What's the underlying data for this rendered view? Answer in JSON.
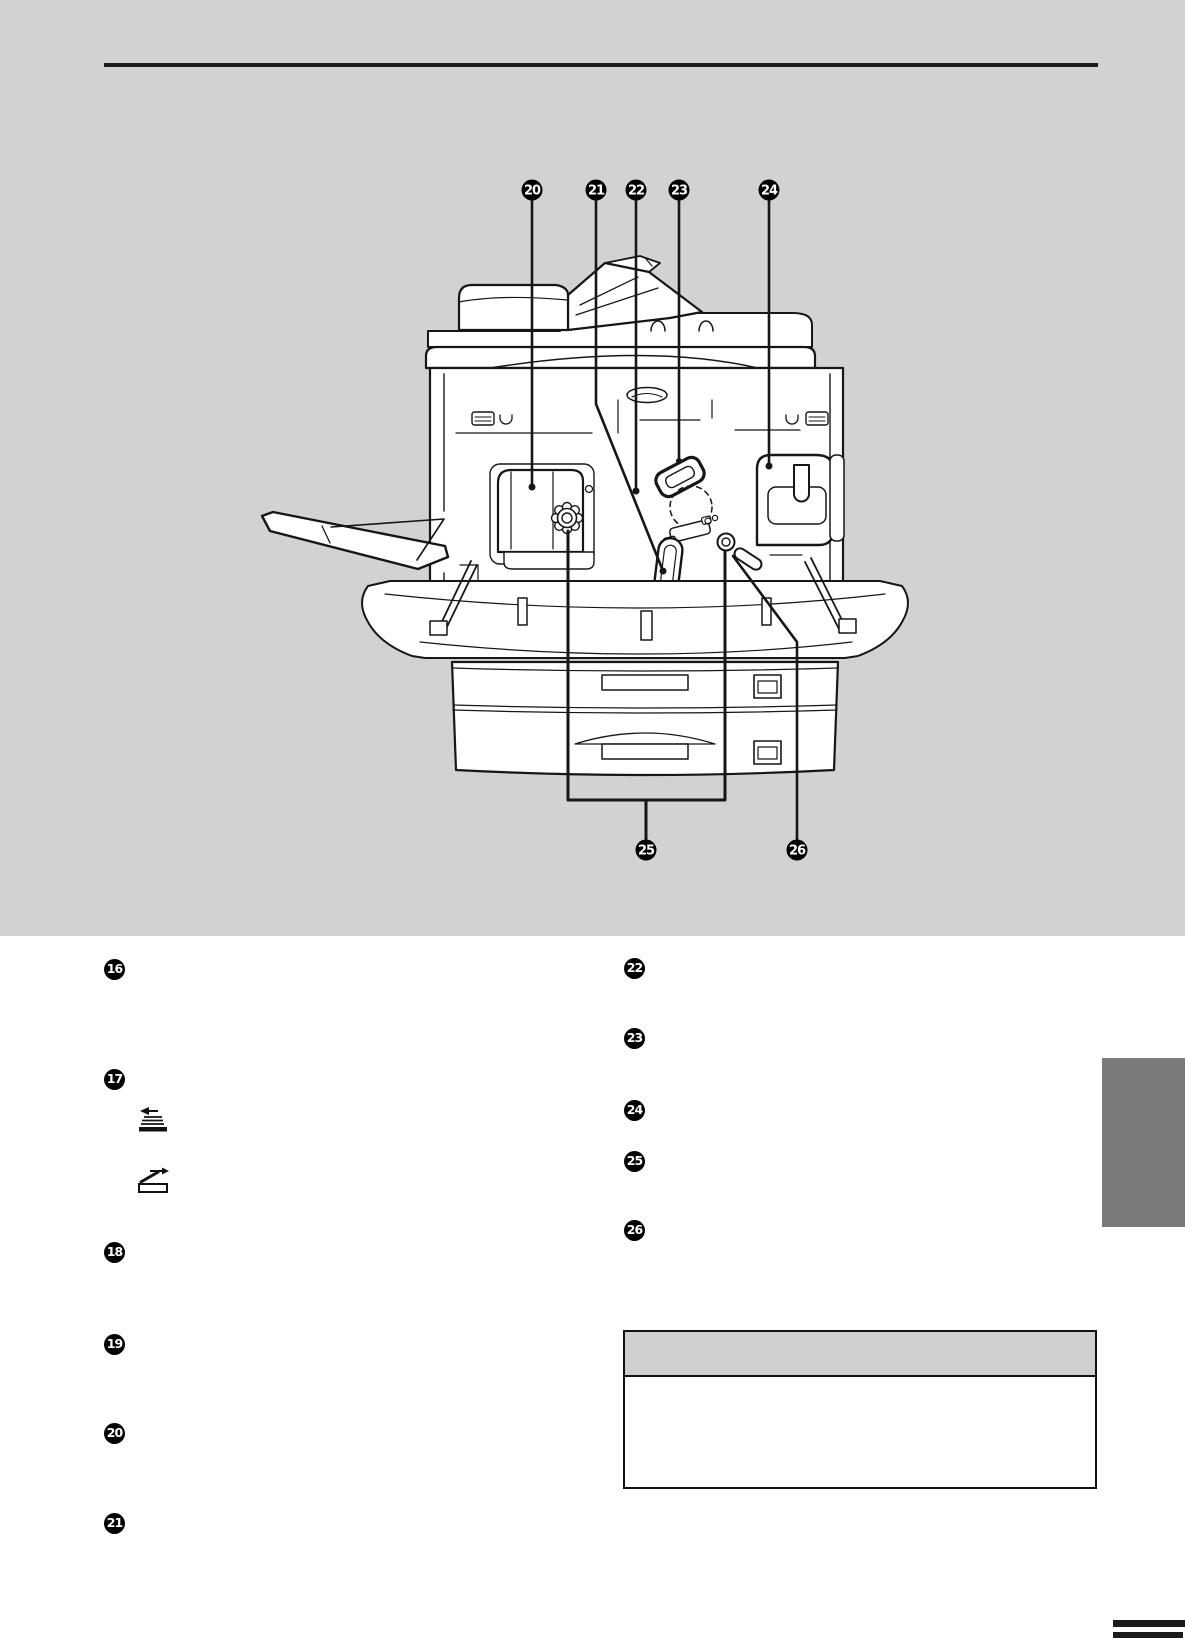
{
  "page": {
    "colors": {
      "banner": "#d2d2d2",
      "side_tab": "#7a7a7a",
      "note_header": "#cfcfcf",
      "line_art": "#161616",
      "footer_marks": "#1a1a1a"
    }
  },
  "diagram": {
    "name": "copier-open-front-cover-view",
    "top_callouts": [
      {
        "number": "20"
      },
      {
        "number": "21"
      },
      {
        "number": "22"
      },
      {
        "number": "23"
      },
      {
        "number": "24"
      }
    ],
    "bottom_callouts": [
      {
        "number": "25"
      },
      {
        "number": "26"
      }
    ]
  },
  "parts_list": {
    "left_column": [
      {
        "number": "16"
      },
      {
        "number": "17"
      },
      {
        "number": "18"
      },
      {
        "number": "19"
      },
      {
        "number": "20"
      },
      {
        "number": "21"
      }
    ],
    "right_column": [
      {
        "number": "22"
      },
      {
        "number": "23"
      },
      {
        "number": "24"
      },
      {
        "number": "25"
      },
      {
        "number": "26"
      }
    ],
    "icons": [
      {
        "name": "face-up-exit-icon"
      },
      {
        "name": "original-on-glass-icon"
      }
    ]
  },
  "note_box": {
    "header_text": "",
    "body_text": ""
  }
}
